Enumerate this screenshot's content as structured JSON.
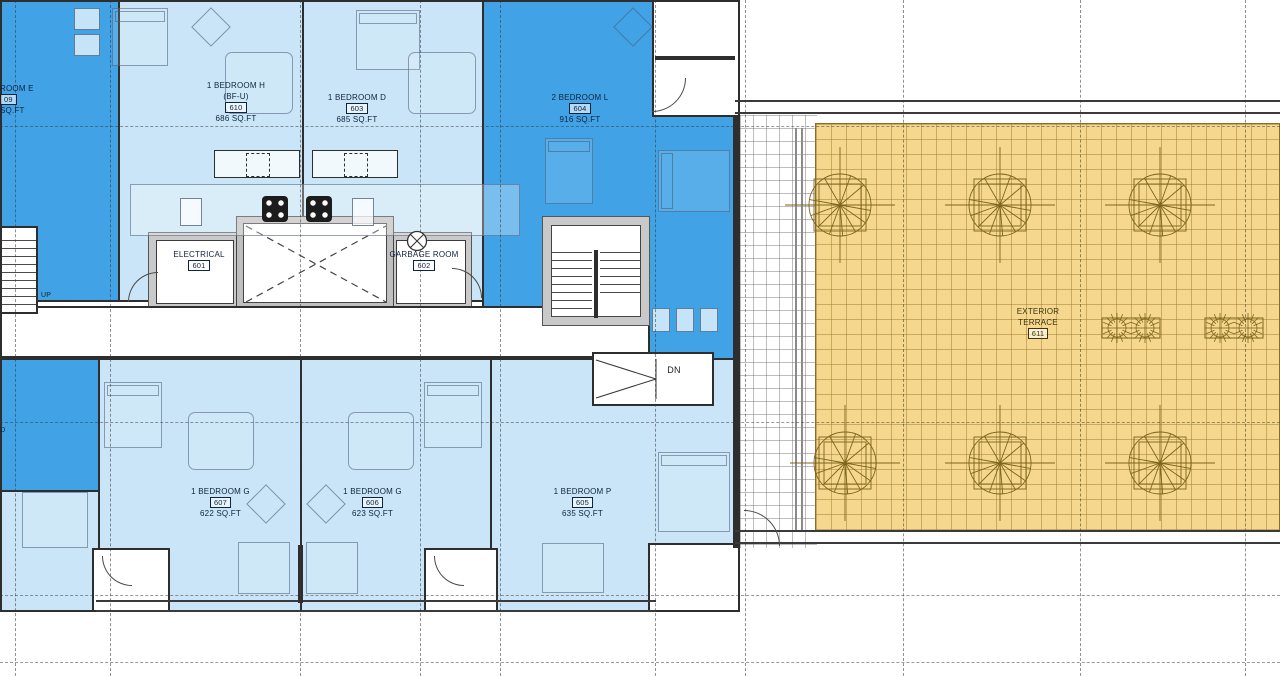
{
  "colors": {
    "dark-blue": "#41a3e6",
    "light-blue": "#c9e5f7",
    "terrace-yellow": "#f5d88e",
    "wall": "#2e2e2e",
    "core-gray": "#c9c9c9",
    "plant-stroke": "#7d641d"
  },
  "labels": {
    "unit_e": {
      "l1": "ROOM E",
      "num": "09",
      "l3": "SQ.FT"
    },
    "unit_h": {
      "name": "1 BEDROOM H",
      "sub": "(BF-U)",
      "num": "610",
      "area": "686 SQ.FT"
    },
    "unit_d": {
      "name": "1 BEDROOM D",
      "num": "603",
      "area": "685 SQ.FT"
    },
    "unit_l": {
      "name": "2 BEDROOM L",
      "num": "604",
      "area": "916 SQ.FT"
    },
    "unit_g607": {
      "name": "1 BEDROOM G",
      "num": "607",
      "area": "622 SQ.FT"
    },
    "unit_g606": {
      "name": "1 BEDROOM G",
      "num": "606",
      "area": "623 SQ.FT"
    },
    "unit_p": {
      "name": "1 BEDROOM P",
      "num": "605",
      "area": "635 SQ.FT"
    },
    "electrical": {
      "name": "ELECTRICAL",
      "num": "601"
    },
    "garbage": {
      "name": "GARBAGE ROOM",
      "num": "602"
    },
    "terrace": {
      "l1": "EXTERIOR",
      "l2": "TERRACE",
      "num": "611"
    },
    "dn": "DN",
    "up": "UP",
    "d_frag": "D"
  }
}
